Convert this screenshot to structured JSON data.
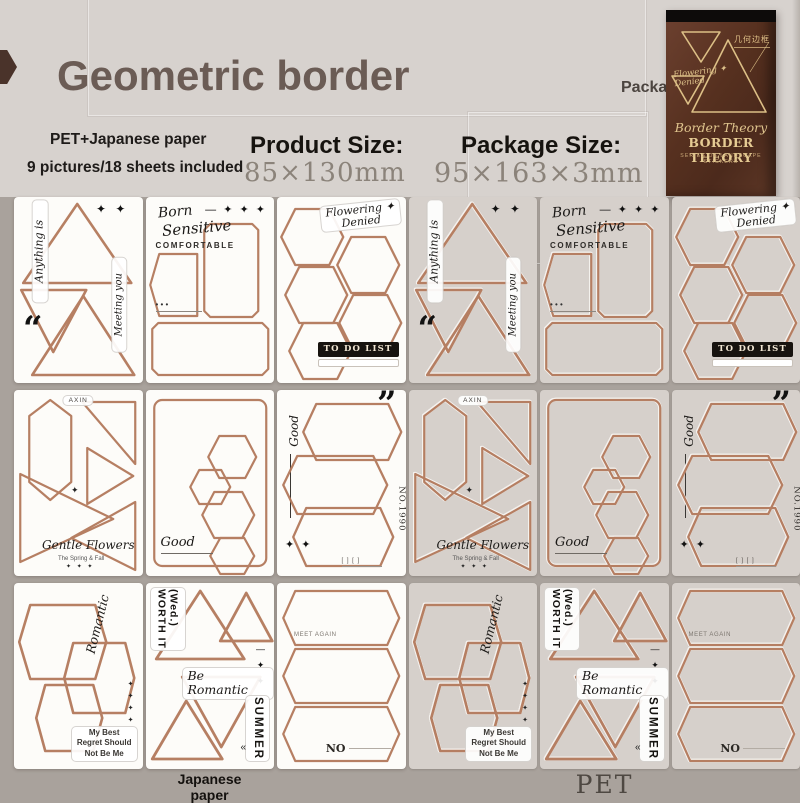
{
  "header": {
    "title": "Geometric border",
    "material_line": "PET+Japanese paper",
    "count_line": "9 pictures/18 sheets included",
    "product_size_label": "Product Size:",
    "product_size_value": "85×130mm",
    "package_size_label": "Package Size:",
    "package_size_value": "95×163×3mm",
    "package_label": "Package",
    "package": {
      "cn_title": "几何边框",
      "corner_script": "Flowering ✦\nDenied",
      "script_title": "Border Theory",
      "title": "BORDER THEORY",
      "subtitle": "SERIES OF LANDSCAPE STICKERS"
    }
  },
  "colors": {
    "copper_border": "#b3795b",
    "header_bg": "#d7d2ce",
    "page_bg": "#a9a29c",
    "sheet_white": "#fdfcf9",
    "sheet_pet": "#d6d0cb",
    "package_brown": "#56301f",
    "gold": "#e0c58e",
    "title_brown": "#6b5c55"
  },
  "groups": [
    {
      "id": "japanese-paper",
      "label": "Japanese\npaper"
    },
    {
      "id": "pet",
      "label": "PET"
    }
  ],
  "sheets": [
    {
      "design": "d1",
      "labels": [
        "Anything is",
        "✦ ✦",
        "Meeting you",
        "“"
      ]
    },
    {
      "design": "d2",
      "labels": [
        "Born",
        "Sensitive",
        "COMFORTABLE",
        "— ✦ ✦ ✦",
        "• • •"
      ]
    },
    {
      "design": "d3",
      "labels": [
        "Flowering ✦\nDenied",
        "TO DO LIST"
      ]
    },
    {
      "design": "d4",
      "labels": [
        "AXIN",
        "✦",
        "Gentle Flowers",
        "The Spring & Fall",
        "✦ ✦ ✦"
      ]
    },
    {
      "design": "d5",
      "labels": [
        "Good"
      ]
    },
    {
      "design": "d6",
      "labels": [
        "Good",
        "”",
        "NO.1990",
        "✦ ✦",
        "[ ] [ ]"
      ]
    },
    {
      "design": "d7",
      "labels": [
        "Romantic",
        "✦\n✦\n✦\n✦",
        "My Best\nRegret Should\nNot Be Me"
      ]
    },
    {
      "design": "d8",
      "labels": [
        "(Wed.)\nWORTH IT",
        "—\n✦\n✦\n✦",
        "Be Romantic",
        "SUMMER",
        "«"
      ]
    },
    {
      "design": "d9",
      "labels": [
        "MEET AGAIN",
        "NO"
      ]
    }
  ]
}
